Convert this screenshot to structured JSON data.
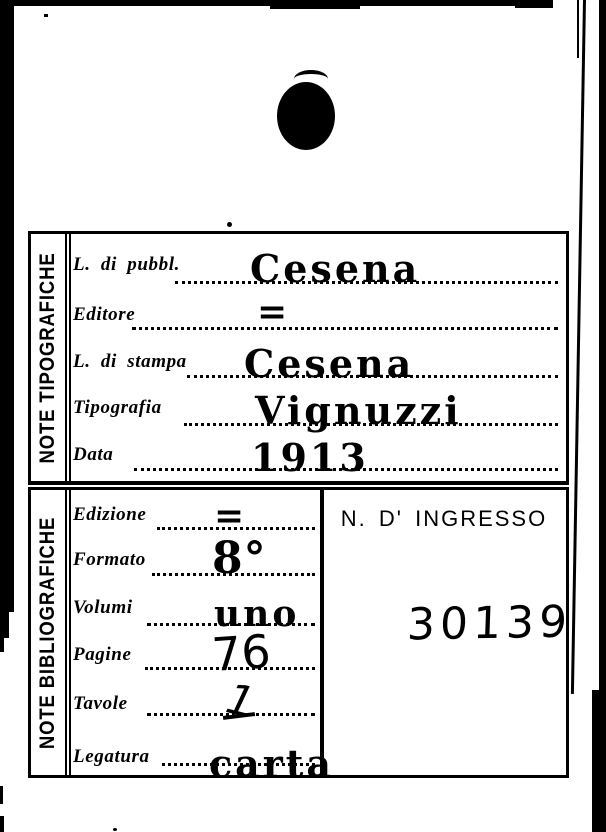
{
  "colors": {
    "paper": "#ffffff",
    "ink": "#000000"
  },
  "tables": [
    {
      "title": "NOTE TIPOGRAFICHE",
      "fields": [
        {
          "label": "L. di pubbl.",
          "value": "Cesena"
        },
        {
          "label": "Editore",
          "value": "="
        },
        {
          "label": "L. di stampa",
          "value": "Cesena"
        },
        {
          "label": "Tipografia",
          "value": "Vignuzzi"
        },
        {
          "label": "Data",
          "value": "1913"
        }
      ]
    },
    {
      "title": "NOTE BIBLIOGRAFICHE",
      "fields": [
        {
          "label": "Edizione",
          "value": "="
        },
        {
          "label": "Formato",
          "value": "8°"
        },
        {
          "label": "Volumi",
          "value": "uno"
        },
        {
          "label": "Pagine",
          "value": "76"
        },
        {
          "label": "Tavole",
          "value": "1"
        },
        {
          "label": "Legatura",
          "value": "carta"
        }
      ]
    }
  ],
  "ingresso": {
    "label": "N. D' INGRESSO",
    "number": "30139"
  }
}
